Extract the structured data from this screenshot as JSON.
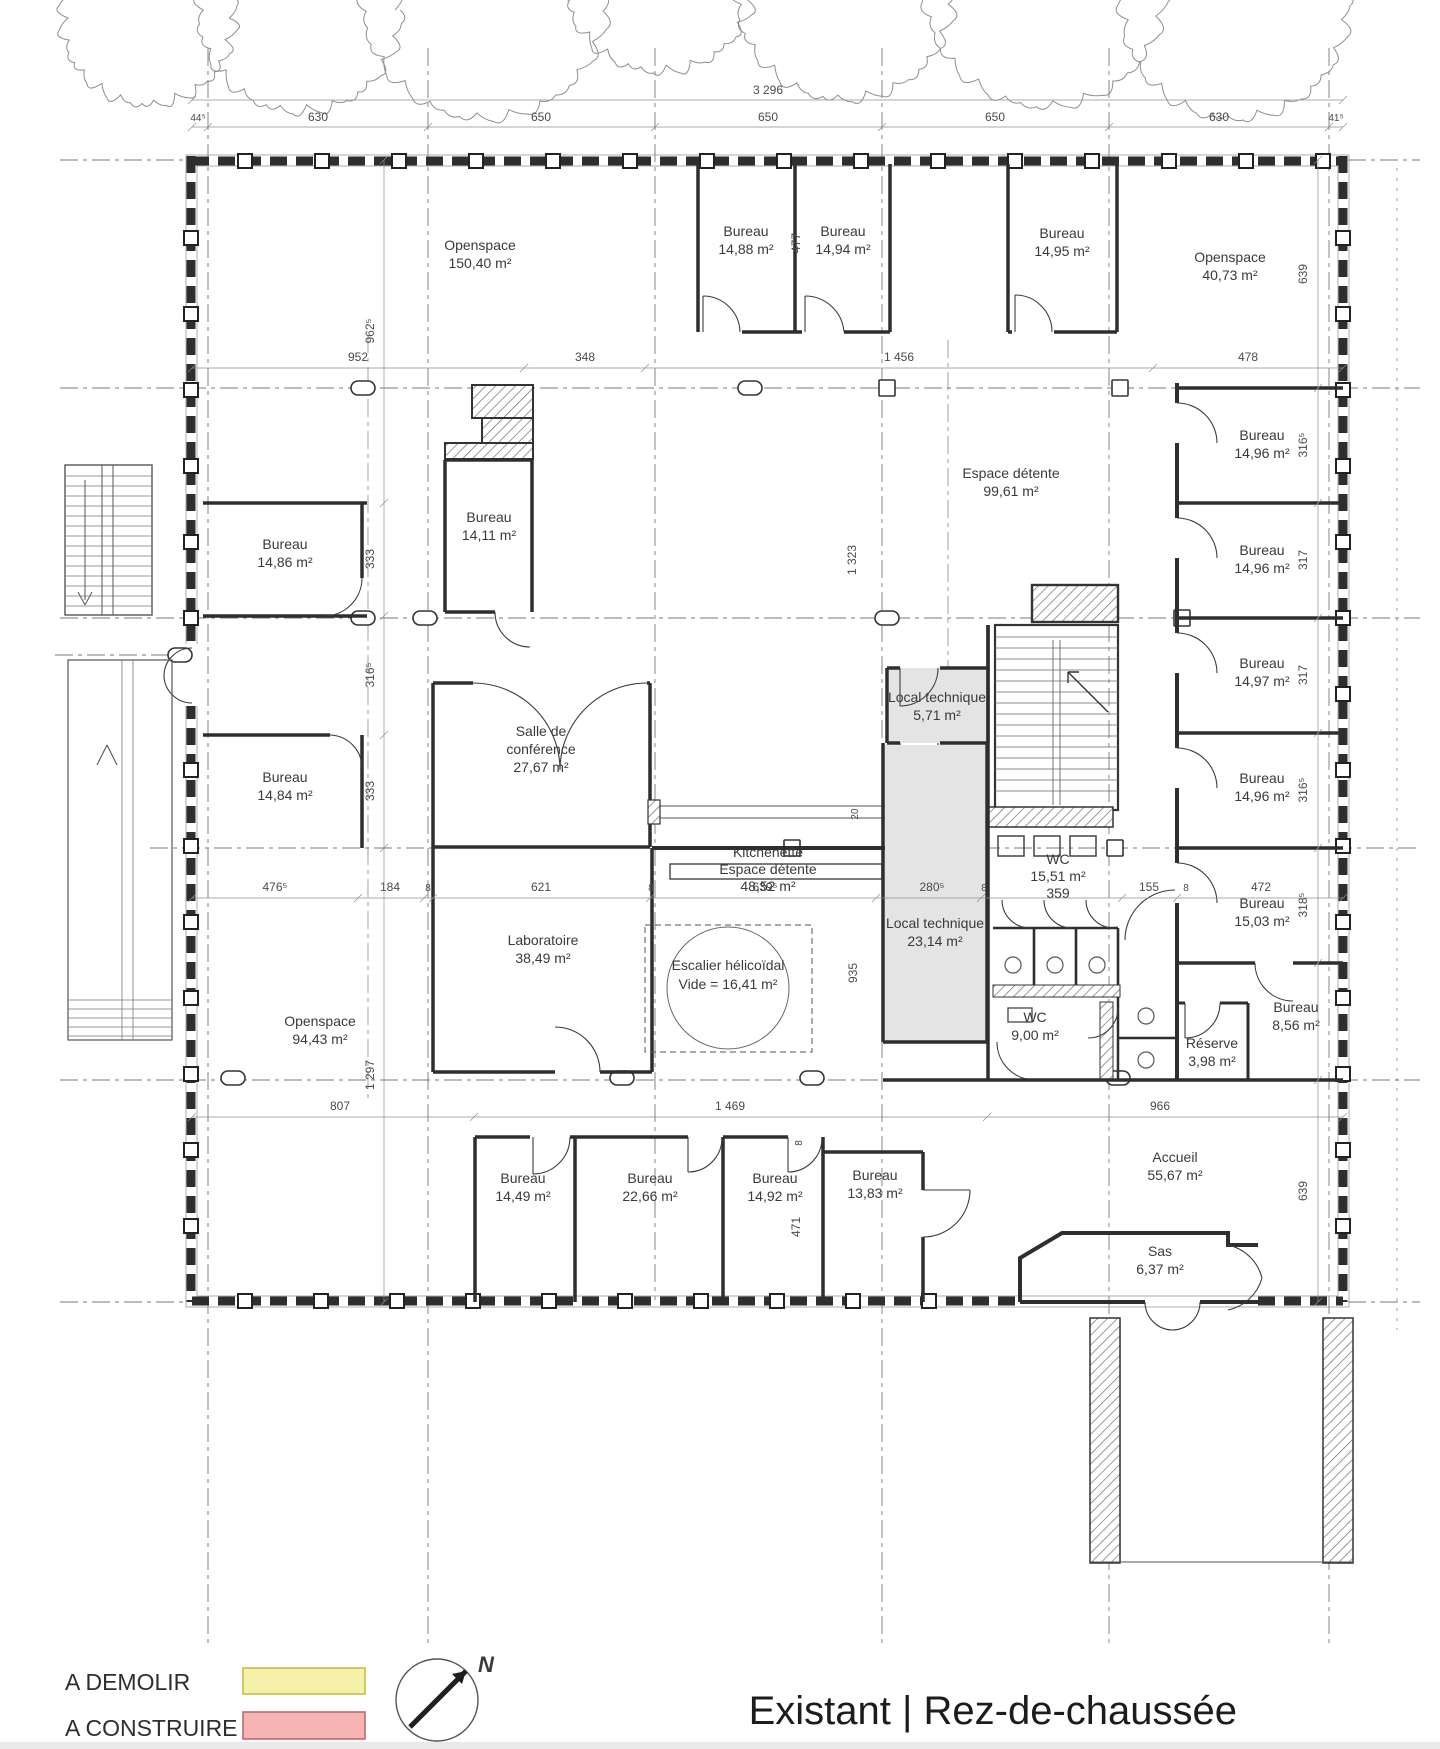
{
  "title": {
    "text": "Existant | Rez-de-chaussée"
  },
  "legend": {
    "demolish_label": "A DEMOLIR",
    "build_label": "A CONSTRUIRE",
    "demolish_fill": "#f6f1a9",
    "demolish_border": "#c9bc45",
    "build_fill": "#f6b5b5",
    "build_border": "#c06a6a"
  },
  "compass": {
    "north_label": "N"
  },
  "rooms": [
    {
      "lines": [
        "Openspace",
        "150,40 m²"
      ]
    },
    {
      "lines": [
        "Bureau",
        "14,88 m²"
      ]
    },
    {
      "lines": [
        "Bureau",
        "14,94 m²"
      ]
    },
    {
      "lines": [
        "Bureau",
        "14,95 m²"
      ]
    },
    {
      "lines": [
        "Openspace",
        "40,73 m²"
      ]
    },
    {
      "lines": [
        "Bureau",
        "14,86 m²"
      ]
    },
    {
      "lines": [
        "Bureau",
        "14,11 m²"
      ]
    },
    {
      "lines": [
        "Espace détente",
        "99,61 m²"
      ]
    },
    {
      "lines": [
        "Bureau",
        "14,96 m²"
      ]
    },
    {
      "lines": [
        "Bureau",
        "14,96 m²"
      ]
    },
    {
      "lines": [
        "Bureau",
        "14,84 m²"
      ]
    },
    {
      "lines": [
        "Salle de",
        "conférence",
        "27,67 m²"
      ]
    },
    {
      "lines": [
        "Local technique",
        "5,71 m²"
      ]
    },
    {
      "lines": [
        "Bureau",
        "14,97 m²"
      ]
    },
    {
      "lines": [
        "Bureau",
        "14,96 m²"
      ]
    },
    {
      "lines": [
        "Kitchenette",
        "Espace détente",
        "48,52 m²"
      ]
    },
    {
      "lines": [
        "WC",
        "15,51 m²",
        "359"
      ]
    },
    {
      "lines": [
        "Laboratoire",
        "38,49 m²"
      ]
    },
    {
      "lines": [
        "Escalier hélicoïdal",
        "Vide = 16,41 m²"
      ]
    },
    {
      "lines": [
        "Local technique",
        "23,14 m²"
      ]
    },
    {
      "lines": [
        "Bureau",
        "15,03 m²"
      ]
    },
    {
      "lines": [
        "WC",
        "9,00 m²"
      ]
    },
    {
      "lines": [
        "Réserve",
        "3,98 m²"
      ]
    },
    {
      "lines": [
        "Bureau",
        "8,56 m²"
      ]
    },
    {
      "lines": [
        "Openspace",
        "94,43 m²"
      ]
    },
    {
      "lines": [
        "Bureau",
        "14,49 m²"
      ]
    },
    {
      "lines": [
        "Bureau",
        "22,66 m²"
      ]
    },
    {
      "lines": [
        "Bureau",
        "14,92 m²"
      ]
    },
    {
      "lines": [
        "Bureau",
        "13,83 m²"
      ]
    },
    {
      "lines": [
        "Accueil",
        "55,67 m²"
      ]
    },
    {
      "lines": [
        "Sas",
        "6,37 m²"
      ]
    }
  ],
  "dims": {
    "total": "3 296",
    "top": [
      "44⁵",
      "630",
      "650",
      "650",
      "650",
      "630",
      "41⁵"
    ],
    "row_a": [
      "952",
      "348",
      "1 456",
      "478"
    ],
    "row_b": [
      "476⁵",
      "184",
      "8",
      "621",
      "8",
      "639⁵",
      "280⁵",
      "8",
      "155",
      "8",
      "472"
    ],
    "row_c": [
      "807",
      "1 469",
      "966"
    ],
    "left": [
      "962⁵",
      "333",
      "316⁵",
      "333",
      "1 297"
    ],
    "right": [
      "639",
      "316⁵",
      "317",
      "317",
      "316⁵",
      "318⁵",
      "639"
    ],
    "inner": {
      "a": "477",
      "b": "1 323",
      "c": "20",
      "d": "935",
      "e": "471",
      "f": "8"
    }
  }
}
